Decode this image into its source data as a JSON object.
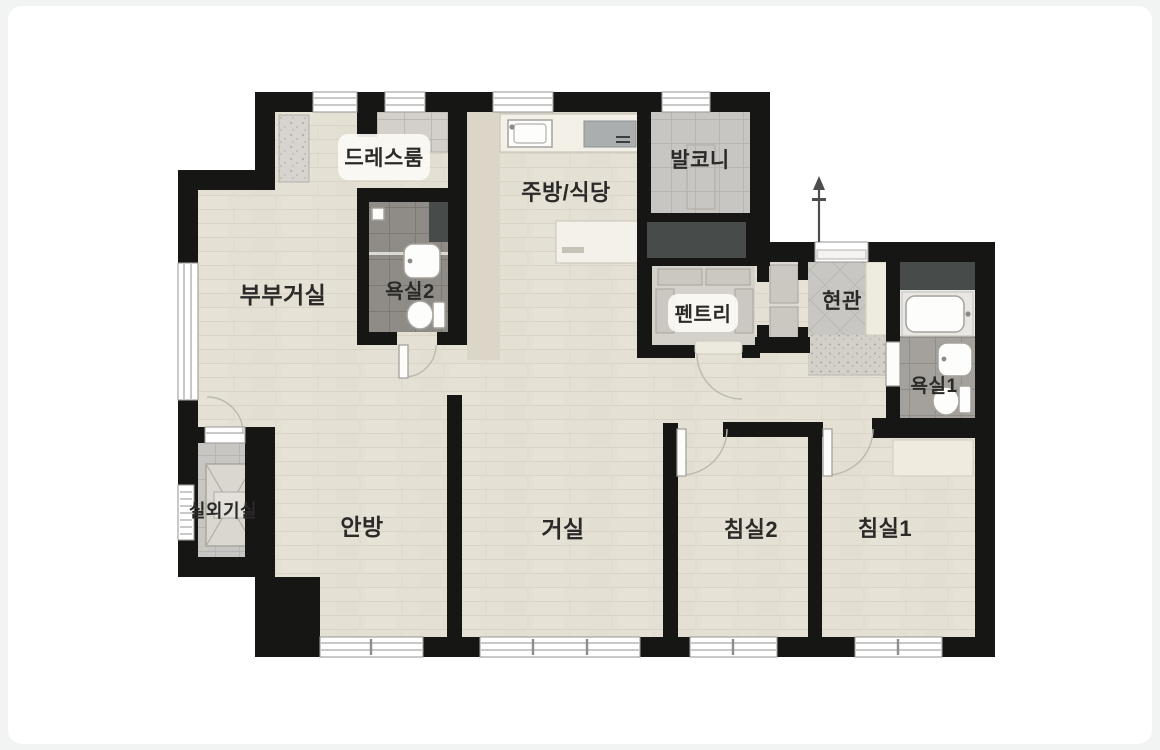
{
  "page": {
    "background": "#f2f3f3",
    "canvas": "#ffffff"
  },
  "floorplan": {
    "kind": "apartment-floor-plan",
    "language": "ko",
    "rooms": [
      {
        "id": "dressroom",
        "label": "드레스룸",
        "fixtures": [
          "cabinets",
          "wardrobe"
        ]
      },
      {
        "id": "bathroom2",
        "label": "욕실2",
        "fixtures": [
          "shower",
          "sink",
          "toilet"
        ]
      },
      {
        "id": "master-living",
        "label": "부부거실",
        "fixtures": [
          "window"
        ]
      },
      {
        "id": "kitchen-dining",
        "label": "주방/식당",
        "fixtures": [
          "kitchen-sink",
          "cooktop",
          "island-table"
        ]
      },
      {
        "id": "balcony",
        "label": "발코니",
        "fixtures": [
          "tiled-floor"
        ]
      },
      {
        "id": "pantry",
        "label": "펜트리",
        "fixtures": [
          "shelves"
        ]
      },
      {
        "id": "entrance",
        "label": "현관",
        "fixtures": [
          "front-door",
          "entry-mat",
          "shoe-closet"
        ]
      },
      {
        "id": "bathroom1",
        "label": "욕실1",
        "fixtures": [
          "bathtub",
          "sink",
          "toilet",
          "storage"
        ]
      },
      {
        "id": "outdoor-unit-room",
        "label": "실외기실",
        "fixtures": [
          "ac-outdoor-unit",
          "louver-window"
        ]
      },
      {
        "id": "master-bedroom",
        "label": "안방",
        "fixtures": [
          "window"
        ]
      },
      {
        "id": "living-room",
        "label": "거실",
        "fixtures": [
          "window"
        ]
      },
      {
        "id": "bedroom2",
        "label": "침실2",
        "fixtures": [
          "window",
          "door"
        ]
      },
      {
        "id": "bedroom1",
        "label": "침실1",
        "fixtures": [
          "window",
          "door",
          "closet"
        ]
      }
    ],
    "colors": {
      "wall": "#161615",
      "wood_floor": "#e4e0d4",
      "kitchen_floor_band": "#dbd6c8",
      "tile_dark": "#8f8c88",
      "tile_medium": "#a4a19c",
      "tile_light": "#c8c6c2",
      "storage_dark": "#474b49",
      "counter": "#f2f0e7",
      "closet_cream": "#efecdf",
      "label_text": "#2b2a28"
    }
  }
}
